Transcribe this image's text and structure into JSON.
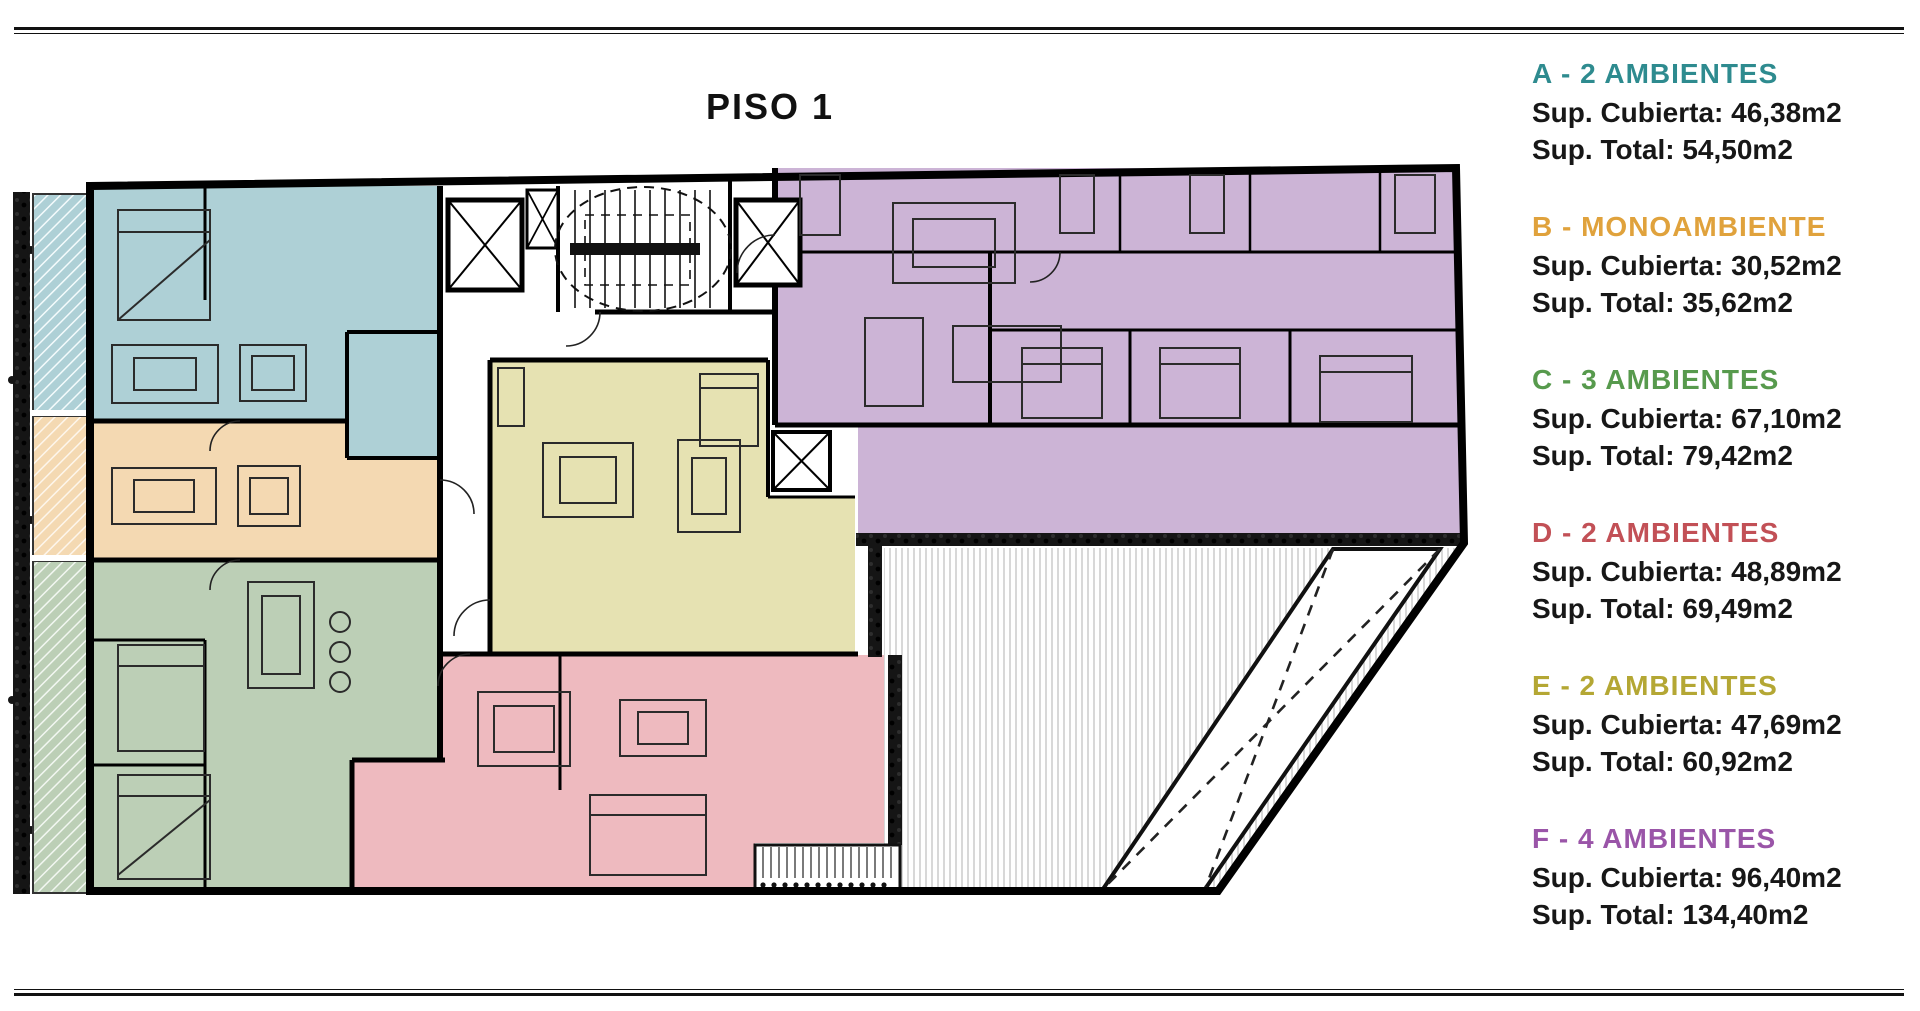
{
  "page": {
    "title": "PISO 1"
  },
  "legend": {
    "items": [
      {
        "id": "A",
        "title": "A - 2 AMBIENTES",
        "covered": "Sup. Cubierta: 46,38m2",
        "total": "Sup. Total: 54,50m2",
        "color": "#2e8b8f"
      },
      {
        "id": "B",
        "title": "B - MONOAMBIENTE",
        "covered": "Sup. Cubierta: 30,52m2",
        "total": "Sup. Total: 35,62m2",
        "color": "#e0a23c"
      },
      {
        "id": "C",
        "title": "C - 3 AMBIENTES",
        "covered": "Sup. Cubierta: 67,10m2",
        "total": "Sup. Total: 79,42m2",
        "color": "#579a4d"
      },
      {
        "id": "D",
        "title": "D - 2 AMBIENTES",
        "covered": "Sup. Cubierta: 48,89m2",
        "total": "Sup. Total: 69,49m2",
        "color": "#c25056"
      },
      {
        "id": "E",
        "title": "E - 2 AMBIENTES",
        "covered": "Sup. Cubierta: 47,69m2",
        "total": "Sup. Total: 60,92m2",
        "color": "#b4a734"
      },
      {
        "id": "F",
        "title": "F - 4 AMBIENTES",
        "covered": "Sup. Cubierta: 96,40m2",
        "total": "Sup. Total: 134,40m2",
        "color": "#9a55a8"
      }
    ]
  },
  "plan": {
    "regions": [
      {
        "id": "A",
        "fill": "#aed0d6"
      },
      {
        "id": "B",
        "fill": "#f4d9b2"
      },
      {
        "id": "C",
        "fill": "#bccfb6"
      },
      {
        "id": "D",
        "fill": "#eebabf"
      },
      {
        "id": "E",
        "fill": "#e6e2b2"
      },
      {
        "id": "F",
        "fill": "#ccb4d6"
      }
    ]
  }
}
